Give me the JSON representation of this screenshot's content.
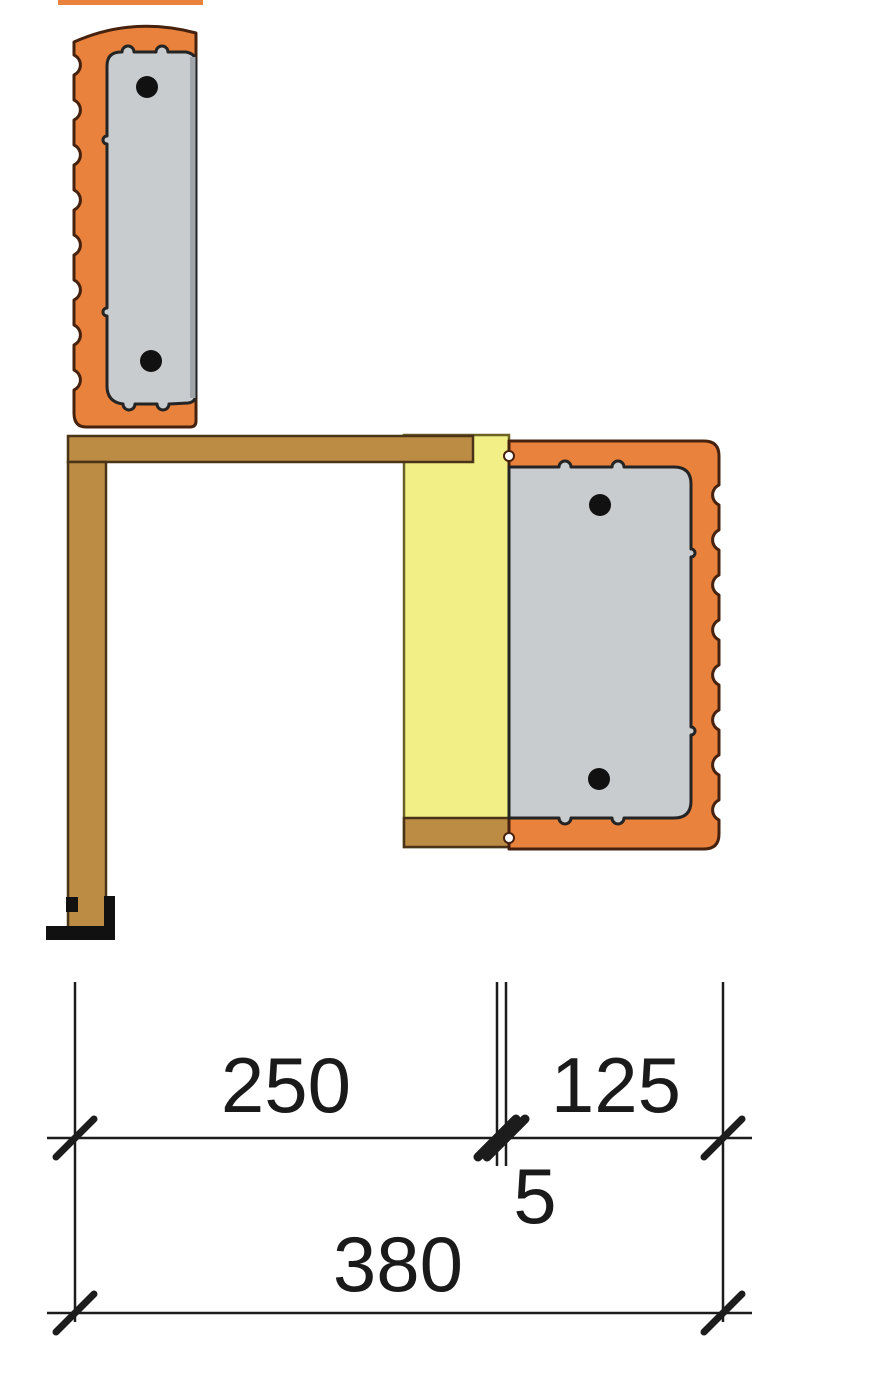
{
  "drawing": {
    "dimensions": {
      "segment_left": "250",
      "segment_right": "125",
      "joint": "5",
      "total": "380"
    },
    "colors": {
      "brick": "#E8823C",
      "brickOutline": "#46220E",
      "concrete": "#C9CCCF",
      "concreteOutline": "#242424",
      "concreteEdge": "#9FA5A9",
      "wood": "#BC8B44",
      "woodOutline": "#4A3418",
      "insulation": "#F1EF86",
      "insulationOutline": "#6D6226",
      "rebar": "#111111",
      "dimLine": "#1C1C1C",
      "dimText": "#1A1A1A",
      "background": "#FFFFFF"
    }
  }
}
